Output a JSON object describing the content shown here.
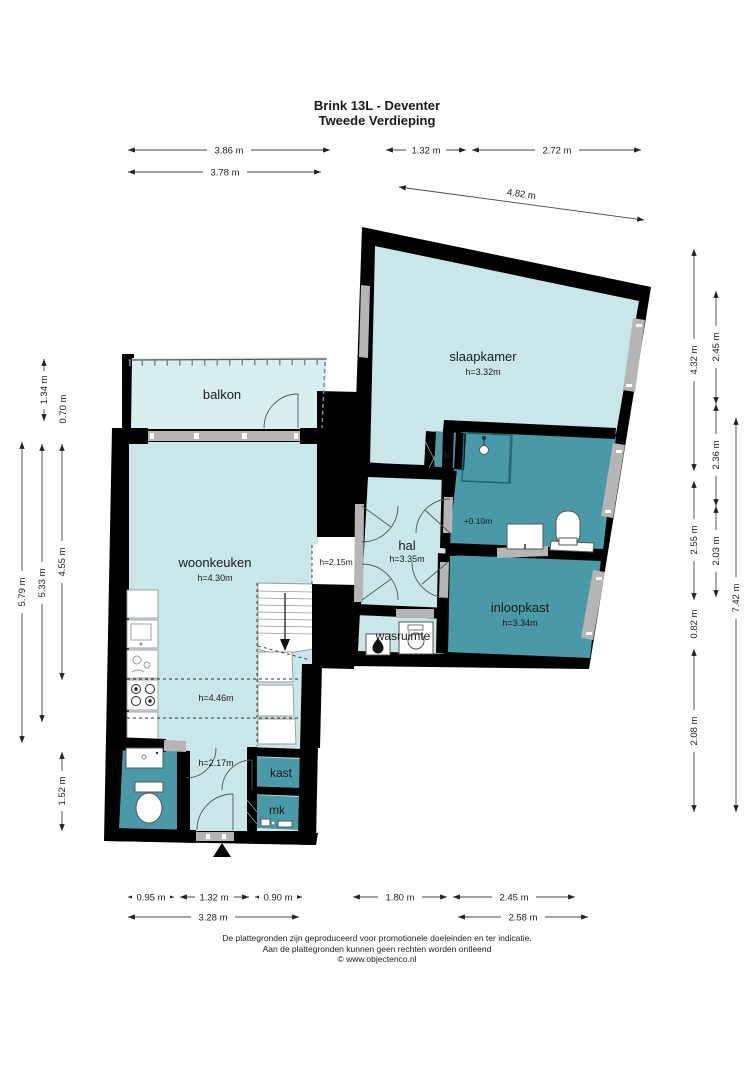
{
  "title": {
    "line1": "Brink 13L - Deventer",
    "line2": "Tweede Verdieping"
  },
  "rooms": {
    "balkon": {
      "name": "balkon"
    },
    "slaapkamer": {
      "name": "slaapkamer",
      "height": "h=3.32m"
    },
    "woonkeuken": {
      "name": "woonkeuken",
      "height": "h=4.30m"
    },
    "hal": {
      "name": "hal",
      "height": "h=3.35m"
    },
    "inloopkast": {
      "name": "inloopkast",
      "height": "h=3.34m"
    },
    "wasruimte": {
      "name": "wasruimte"
    },
    "kast": {
      "name": "kast"
    },
    "mk": {
      "name": "mk"
    },
    "k": {
      "name": "k"
    }
  },
  "annotations": {
    "ceiling_mid": "h=4.46m",
    "ceiling_low": "h=2.17m",
    "ceiling_opening": "h=2.15m",
    "floor_level": "+0.10m"
  },
  "dimensions": {
    "top": [
      "3.86 m",
      "1.32 m",
      "2.72 m",
      "3.78 m",
      "4.82 m"
    ],
    "left": [
      "1.34 m",
      "0.70 m",
      "5.79 m",
      "5.33 m",
      "4.55 m",
      "1.52 m"
    ],
    "right": [
      "4.32 m",
      "2.45 m",
      "2.36 m",
      "2.55 m",
      "2.03 m",
      "0.82 m",
      "7.42 m",
      "2.08 m"
    ],
    "bottom": [
      "0.95 m",
      "1.32 m",
      "0.90 m",
      "1.80 m",
      "2.45 m",
      "3.28 m",
      "2.58 m"
    ]
  },
  "footer": {
    "line1": "De plattegronden zijn geproduceerd voor promotionele doeleinden en ter indicatie.",
    "line2": "Aan de plattegronden kunnen geen rechten worden ontleend",
    "line3": "© www.objectenco.nl"
  },
  "colors": {
    "room_light": "#c9e6e8",
    "room_dark": "#4a99a8",
    "balcony": "#d8efef",
    "wall": "#000000",
    "opening": "#b5b5b5"
  }
}
